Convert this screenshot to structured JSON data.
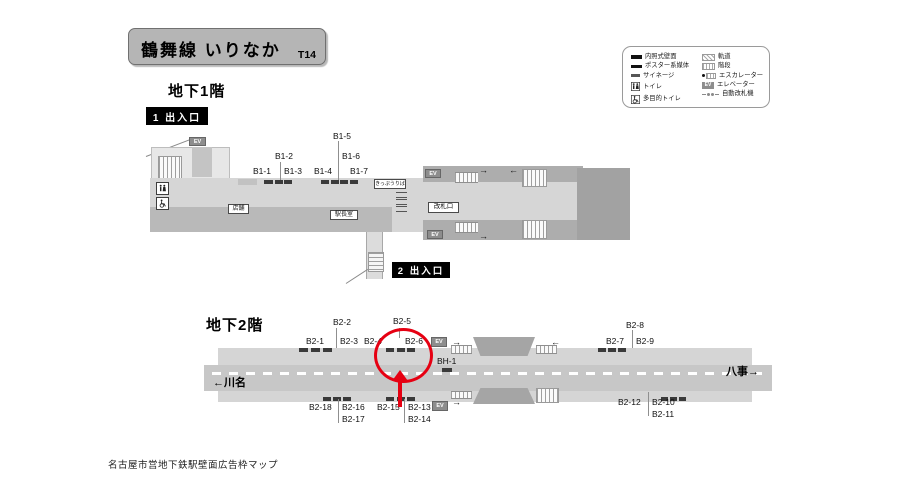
{
  "station": {
    "title": "鶴舞線 いりなか",
    "code": "T14"
  },
  "legend": {
    "left": [
      {
        "icon": "lit-wall-panel",
        "label": "内照式壁面"
      },
      {
        "icon": "poster-media",
        "label": "ポスター系媒体"
      },
      {
        "icon": "signage",
        "label": "サイネージ"
      },
      {
        "icon": "toilet",
        "label": "トイレ"
      },
      {
        "icon": "accessible-toilet",
        "label": "多目的トイレ"
      }
    ],
    "right": [
      {
        "icon": "track",
        "label": "軌道"
      },
      {
        "icon": "stairs",
        "label": "階段"
      },
      {
        "icon": "escalator",
        "label": "エスカレーター"
      },
      {
        "icon": "elevator",
        "label": "エレベーター"
      },
      {
        "icon": "ticket-gate",
        "label": "自動改札機"
      }
    ]
  },
  "floor1": {
    "heading": "地下1階",
    "exit1_label": "1 出入口",
    "exit2_label": "2 出入口",
    "ads": [
      "B1-1",
      "B1-2",
      "B1-3",
      "B1-4",
      "B1-5",
      "B1-6",
      "B1-7"
    ],
    "ticket_office_label": "きっぷうりば",
    "gate_label": "改札口",
    "store_label": "店舗",
    "office_label": "駅長室"
  },
  "floor2": {
    "heading": "地下2階",
    "ads_top": [
      "B2-1",
      "B2-2",
      "B2-3",
      "B2-4",
      "B2-5",
      "B2-6",
      "B2-7",
      "B2-8",
      "B2-9"
    ],
    "ads_bottom": [
      "B2-10",
      "B2-11",
      "B2-12",
      "B2-13",
      "B2-14",
      "B2-15",
      "B2-16",
      "B2-17",
      "B2-18"
    ],
    "bh_label": "BH-1",
    "direction_left": "←川名",
    "direction_right": "八事→"
  },
  "ev_label": "EV",
  "icons": {
    "arrow_right": "→",
    "arrow_left": "←"
  },
  "colors": {
    "highlight_red": "#e60012",
    "map_light": "#d5d5d5",
    "map_mid": "#c7c7c7",
    "map_dark": "#a9a9a9"
  },
  "footer": "名古屋市営地下鉄駅壁面広告枠マップ"
}
